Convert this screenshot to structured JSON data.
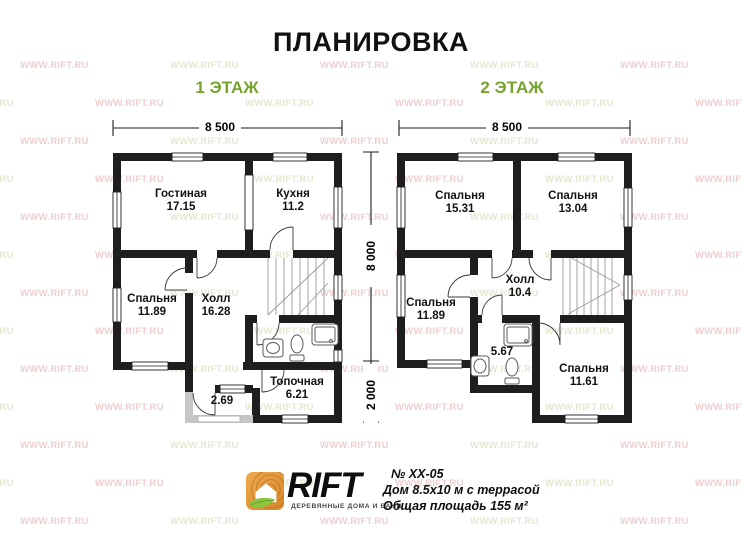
{
  "title": "ПЛАНИРОВКА",
  "watermark": {
    "text": "WWW.RIFT.RU"
  },
  "floor1": {
    "label": "1 ЭТАЖ",
    "width_dim": "8 500",
    "rooms": [
      {
        "name": "Гостиная",
        "area": "17.15"
      },
      {
        "name": "Кухня",
        "area": "11.2"
      },
      {
        "name": "Спальня",
        "area": "11.89"
      },
      {
        "name": "Холл",
        "area": "16.28"
      },
      {
        "name": "Топочная",
        "area": "6.21"
      },
      {
        "name": "",
        "area": "2.69"
      }
    ]
  },
  "floor2": {
    "label": "2 ЭТАЖ",
    "width_dim": "8 500",
    "rooms": [
      {
        "name": "Спальня",
        "area": "15.31"
      },
      {
        "name": "Спальня",
        "area": "13.04"
      },
      {
        "name": "Спальня",
        "area": "11.89"
      },
      {
        "name": "Холл",
        "area": "10.4"
      },
      {
        "name": "",
        "area": "5.67"
      },
      {
        "name": "Спальня",
        "area": "11.61"
      }
    ]
  },
  "dimensions": {
    "height_main": "8 000",
    "height_lower": "2 000"
  },
  "footer": {
    "brand": "RIFT",
    "tagline": "ДЕРЕВЯННЫЕ ДОМА И БАНИ",
    "project_no": "№ ХХ-05",
    "house": "Дом 8.5х10 м с террасой",
    "total_area": "Общая площадь 155 м²"
  },
  "colors": {
    "wall": "#1e1e1e",
    "floor_label_green": "#76a42c",
    "watermark_pink": "#eecfcf",
    "watermark_green": "#e2e9d1"
  }
}
